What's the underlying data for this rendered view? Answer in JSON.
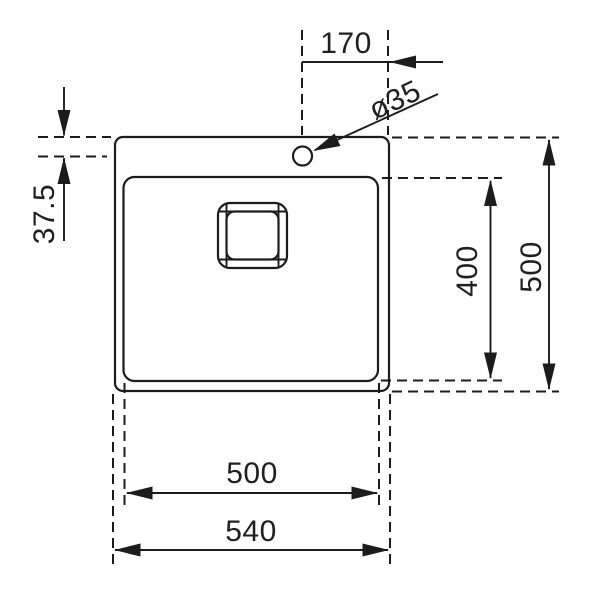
{
  "drawing": {
    "background_color": "#ffffff",
    "line_color": "#1c1c1c",
    "labels": {
      "hole_offset_from_right": "170",
      "hole_diameter": "ø35",
      "hole_offset_from_top": "37.5",
      "bowl_depth": "400",
      "overall_depth": "500",
      "bowl_width": "500",
      "overall_width": "540"
    }
  }
}
